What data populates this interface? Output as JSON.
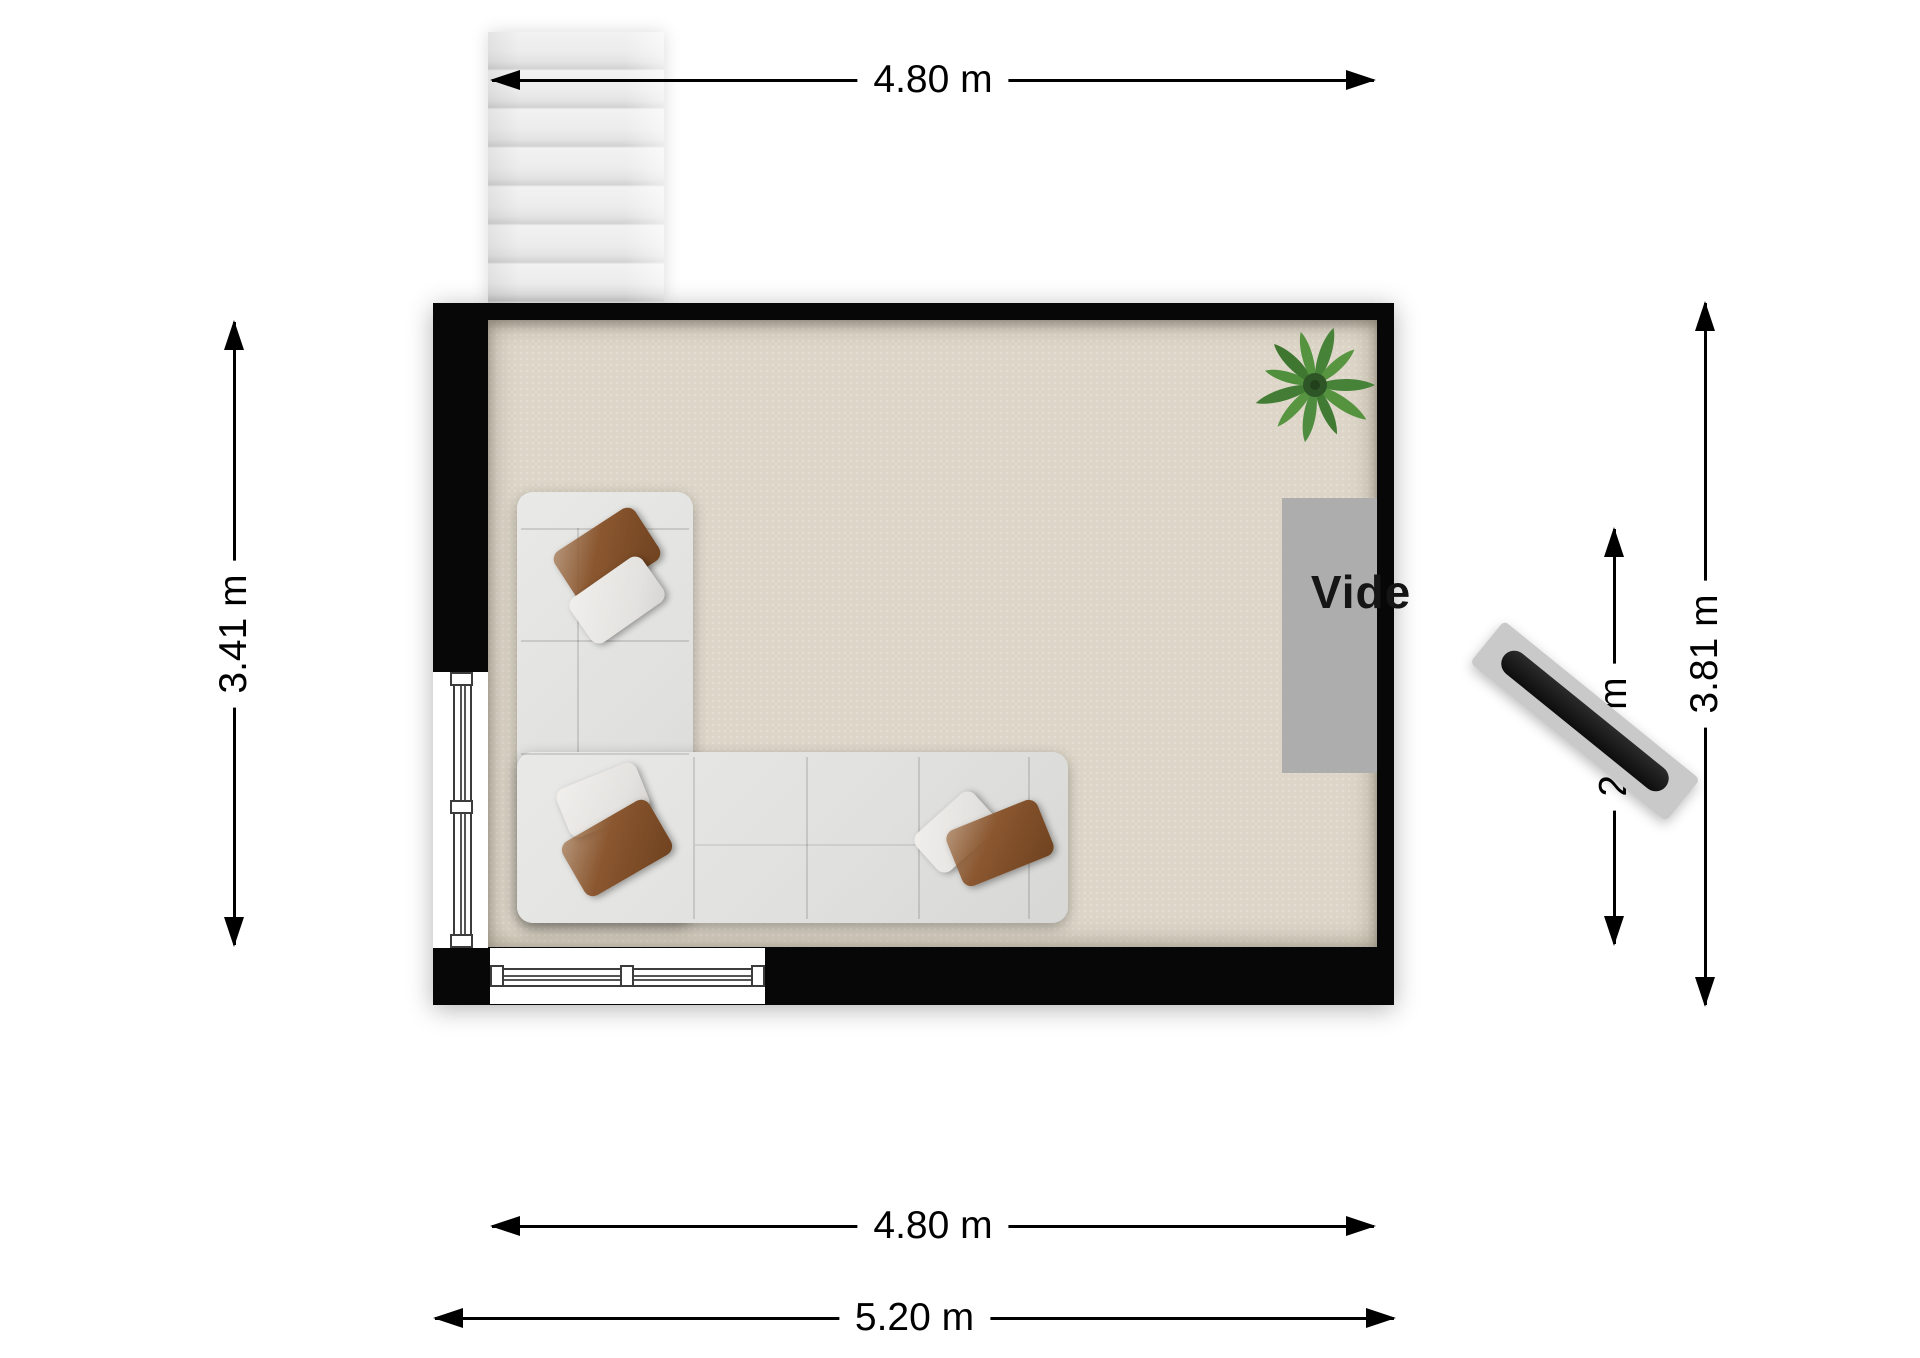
{
  "plan": {
    "room_label": "Vide",
    "dimensions": {
      "top_inner": "4.80 m",
      "bottom_inner": "4.80 m",
      "bottom_outer": "5.20 m",
      "left_inner": "3.41 m",
      "right_inner": "2.28 m",
      "right_outer": "3.81 m"
    },
    "objects": {
      "staircase": "stairs",
      "sofa": "l-shaped-sofa",
      "radiator": "wall-heater-on-plinth",
      "plant": "green-plant",
      "void_opening": "gray-opening",
      "window_left": "window",
      "window_bottom": "window"
    },
    "colors": {
      "wall": "#070707",
      "floor": "#ddd6c8",
      "outside": "#ffffff",
      "stairs": "#ececec",
      "sofa": "#e4e4e2",
      "pillow_brown": "#8a5730",
      "pillow_white": "#ece9e6",
      "radiator_base": "#c9c9c9",
      "radiator_bar": "#141414",
      "plant_green": "#4e8c3f",
      "void_opening": "#adadad",
      "dimension": "#000000"
    }
  }
}
